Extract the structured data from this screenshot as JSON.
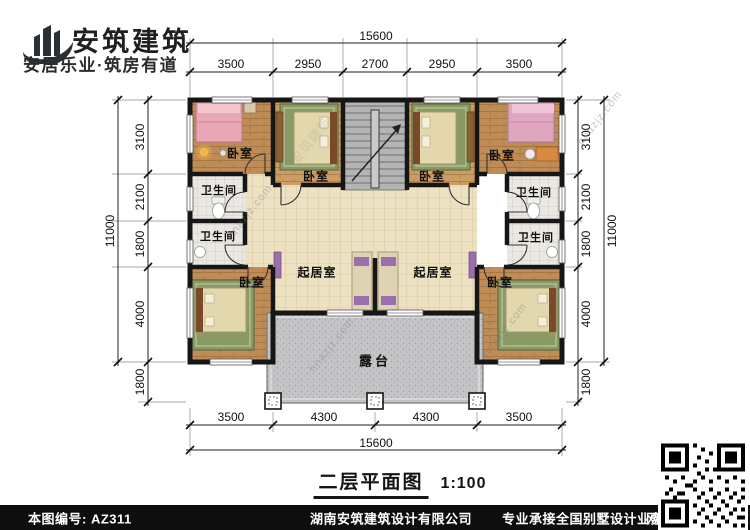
{
  "brand": {
    "name": "安筑建筑",
    "tagline": "安居乐业·筑房有道"
  },
  "plan": {
    "rooms": {
      "bedroom_tl": "卧室",
      "bedroom_inner_l": "卧室",
      "bedroom_inner_r": "卧室",
      "bedroom_tr": "卧室",
      "bath_l1": "卫生间",
      "bath_l2": "卫生间",
      "bath_r1": "卫生间",
      "bath_r2": "卫生间",
      "bedroom_bl": "卧室",
      "living_l": "起居室",
      "living_r": "起居室",
      "bedroom_br": "卧室",
      "terrace": "露台"
    },
    "watermark": "hnazjz.com",
    "watermark_brand": "安筑建筑"
  },
  "dimensions": {
    "top": {
      "total": "15600",
      "segments": [
        "3500",
        "2950",
        "2700",
        "2950",
        "3500"
      ]
    },
    "bottom": {
      "total": "15600",
      "segments": [
        "3500",
        "4300",
        "4300",
        "3500"
      ]
    },
    "left": {
      "total": "11000",
      "segments": [
        "3100",
        "2100",
        "1800",
        "4000",
        "1800"
      ]
    },
    "right": {
      "total": "11000",
      "segments": [
        "3100",
        "2100",
        "1800",
        "4000",
        "1800"
      ]
    }
  },
  "title_block": {
    "name": "二层平面图",
    "scale": "1:100"
  },
  "footer": {
    "sheet_no": "本图编号: AZ311",
    "company": "湖南安筑建筑设计有限公司",
    "service": "专业承接全国别墅设计业务",
    "phone": "咨询电话: 400-8070-511",
    "qr_label": "网"
  },
  "colors": {
    "wall": "#161616",
    "wood_floor": "#bf8c55",
    "wood_floor_inner": "#cb9d63",
    "tile_floor": "#ece2c2",
    "bath_floor": "#eae8e1",
    "stair": "#b4b4b4",
    "terrace": "#c4c4c7",
    "bed_pink": "#e8a6b6",
    "rug_green": "#8a9a66",
    "accent_purple": "#9b6fae",
    "footer_bg": "#0e0e0e"
  }
}
